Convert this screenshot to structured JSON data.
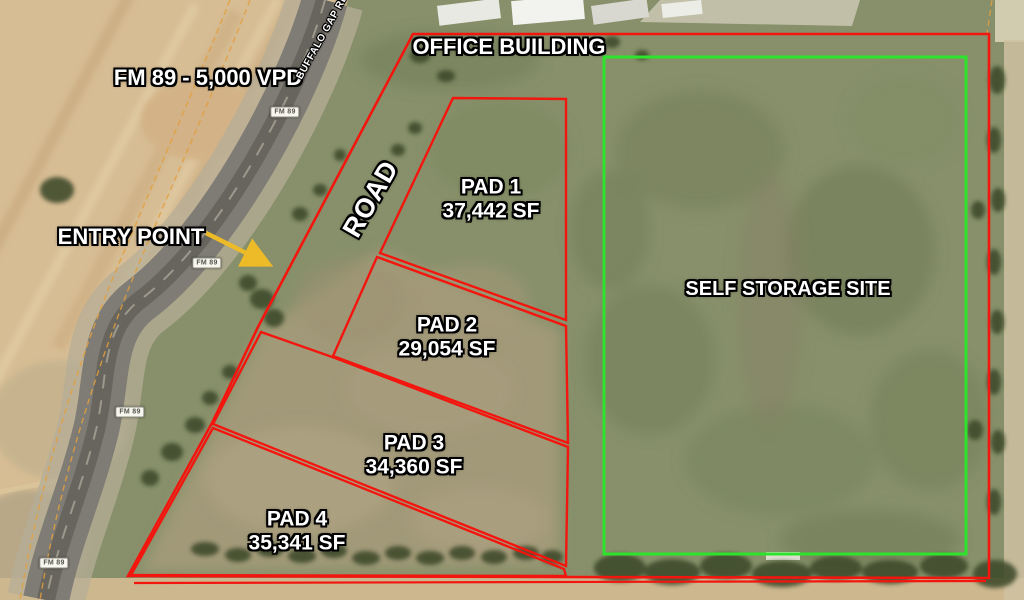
{
  "map": {
    "annotations": {
      "traffic": "FM 89 - 5,000 VPD",
      "street": "BUFFALO GAP RD",
      "shield": "FM 89",
      "office": "OFFICE BUILDING",
      "entry": "ENTRY POINT",
      "road": "ROAD",
      "storage": "SELF STORAGE SITE"
    },
    "pads": [
      {
        "name": "PAD 1",
        "area": "37,442 SF"
      },
      {
        "name": "PAD 2",
        "area": "29,054 SF"
      },
      {
        "name": "PAD 3",
        "area": "34,360 SF"
      },
      {
        "name": "PAD 4",
        "area": "35,341 SF"
      }
    ],
    "colors": {
      "site_boundary": "#f2160f",
      "storage_outline": "#2de32b",
      "entry_arrow": "#eebb28"
    }
  }
}
